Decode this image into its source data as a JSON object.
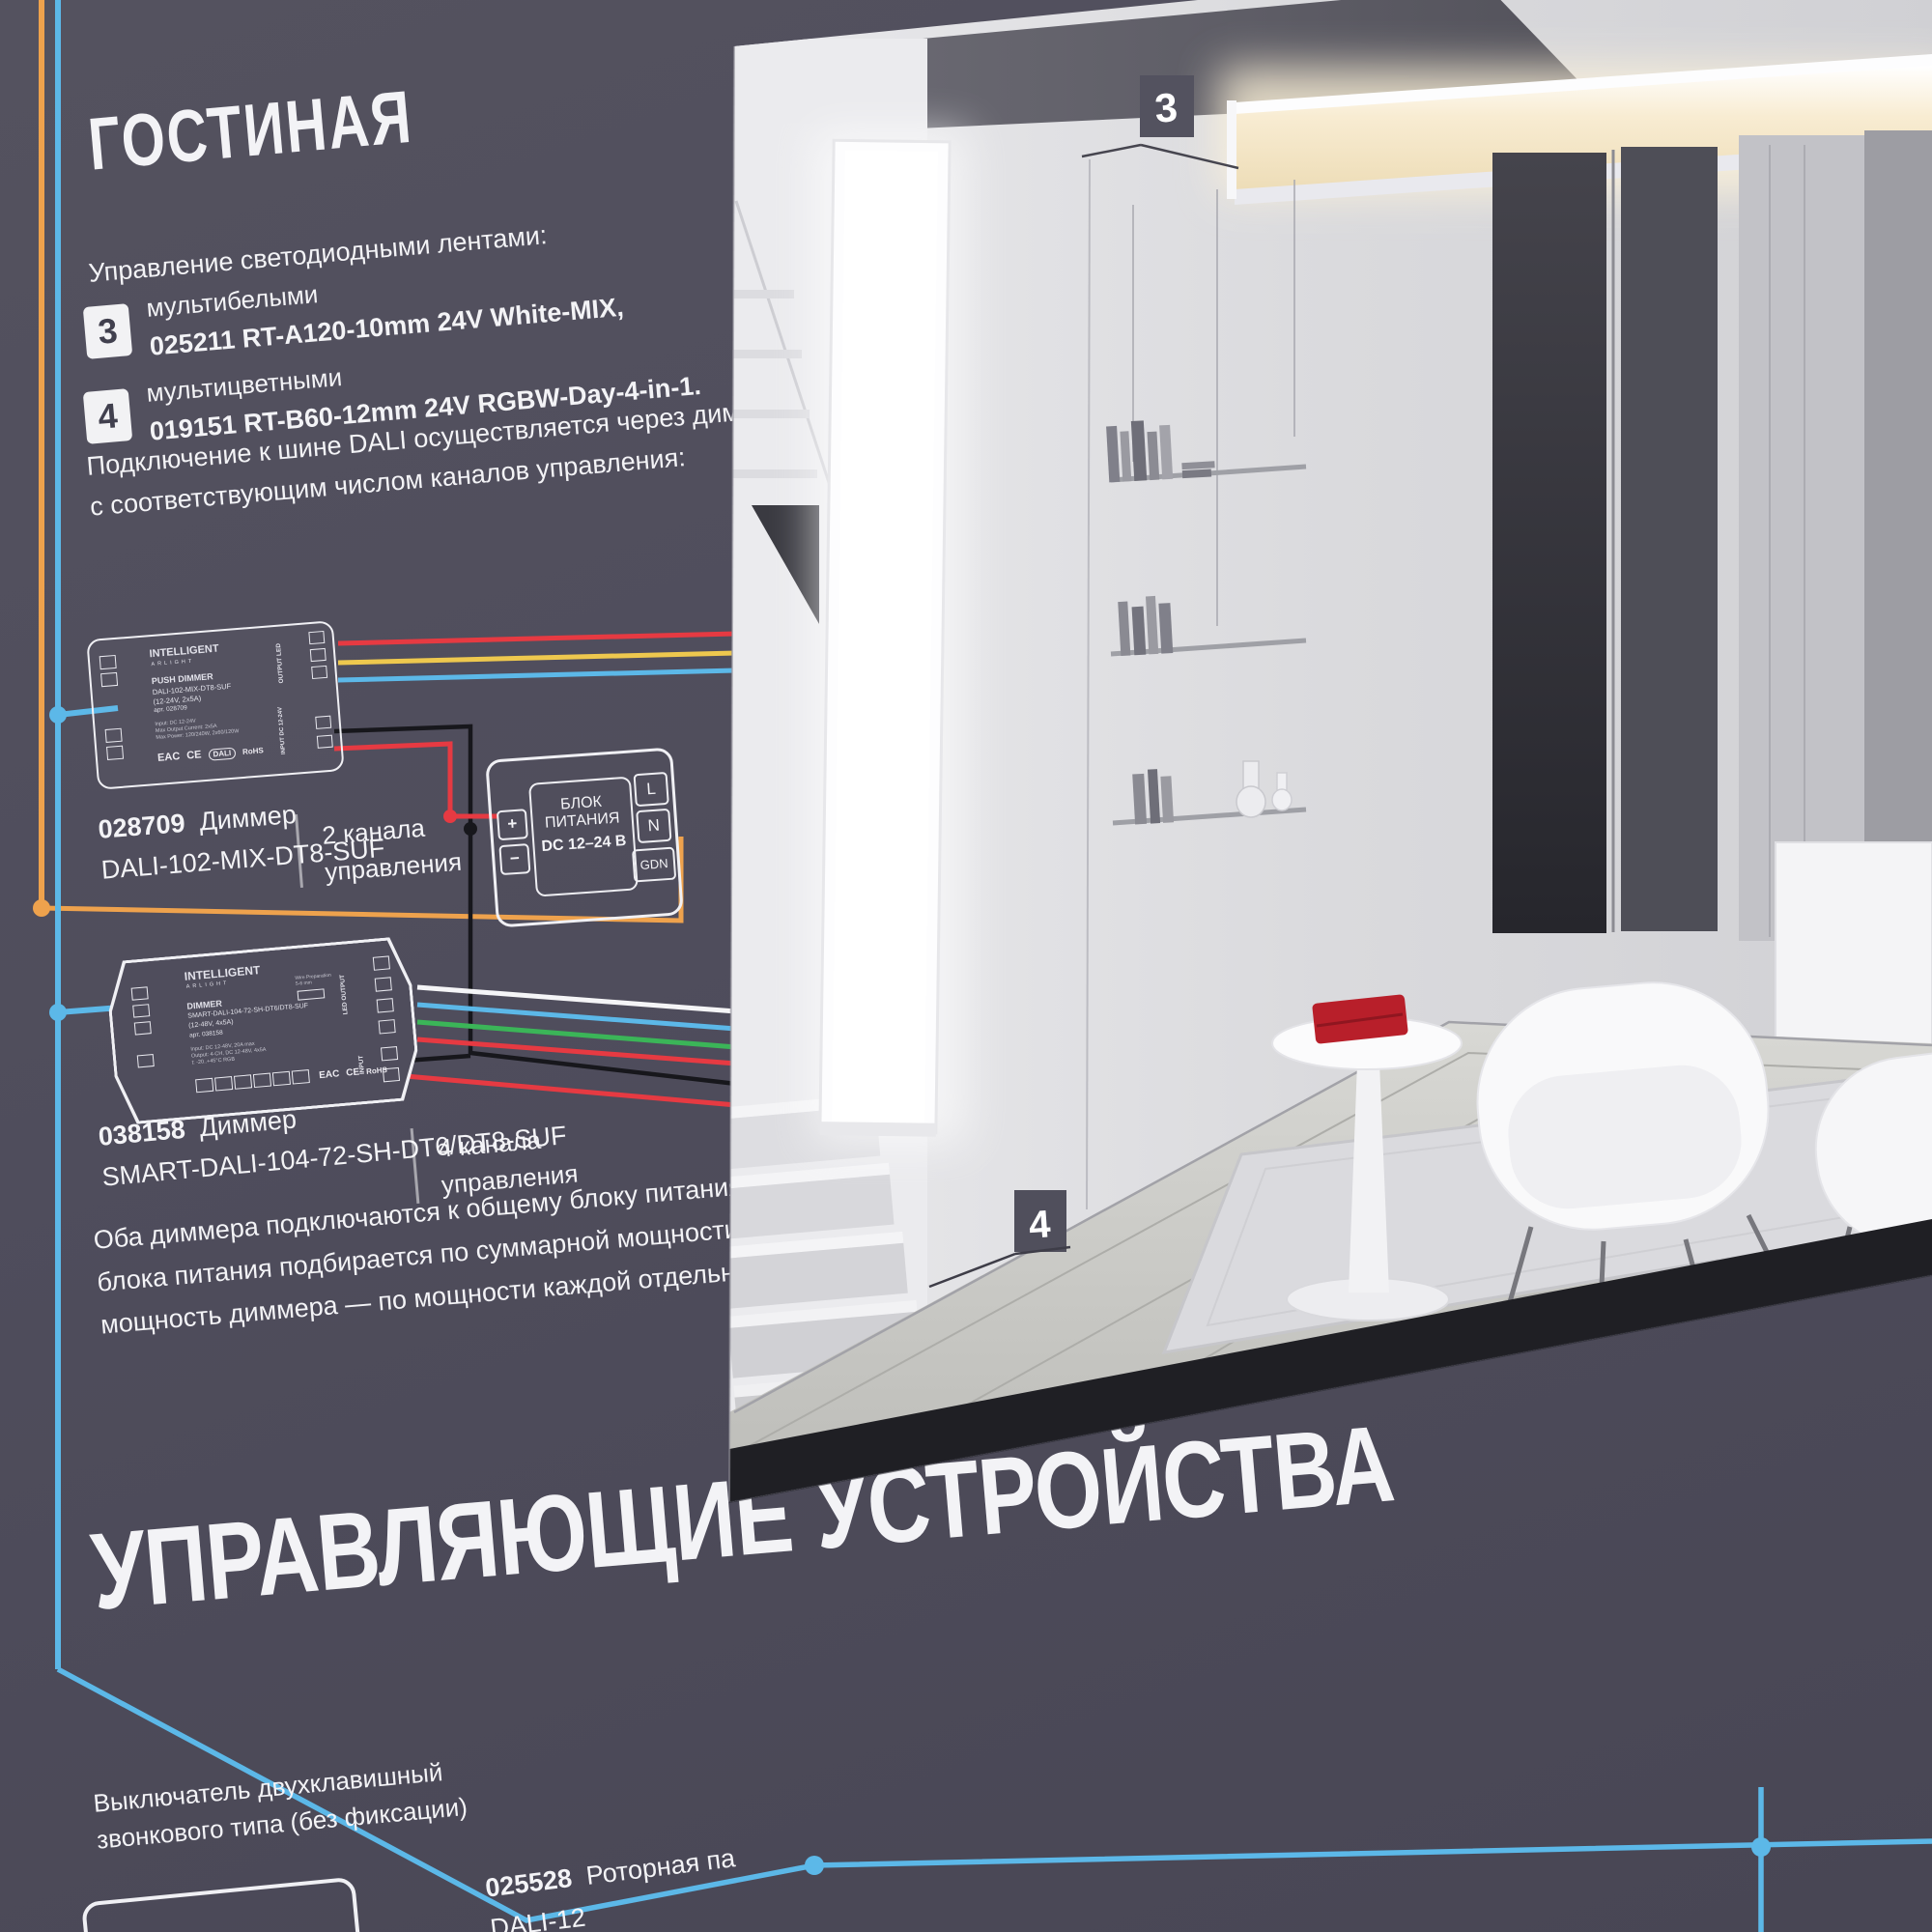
{
  "colors": {
    "board_bg": "#4f4d5c",
    "wire_orange": "#eea24d",
    "wire_cyan": "#5cb8e8",
    "wire_red": "#e63a42",
    "wire_yellow": "#eec84e",
    "wire_green": "#3bb558",
    "wire_white": "#f5f5f7",
    "wire_black": "#17171c",
    "accent_red_object": "#b81f2a",
    "led_warm": "#f3e3c3"
  },
  "header": {
    "title": "ГОСТИНАЯ"
  },
  "intro": "Управление светодиодными лентами:",
  "strips": [
    {
      "badge": "3",
      "kind": "мультибелыми",
      "model": "025211 RT-A120-10mm 24V White-MIX,"
    },
    {
      "badge": "4",
      "kind": "мультицветными",
      "model": "019151 RT-B60-12mm 24V RGBW-Day-4-in-1."
    }
  ],
  "dali_note": [
    "Подключение к шине DALI осуществляется через диммеры DALI",
    "с соответствующим числом каналов управления:"
  ],
  "dimmer1": {
    "art": "028709",
    "name": "Диммер",
    "model": "DALI-102-MIX-DT8-SUF",
    "channels_1": "2 канала",
    "channels_2": "управления",
    "device": {
      "brand": "INTELLIGENT",
      "brand_sub": "ARLIGHT",
      "title": "PUSH DIMMER",
      "model": "DALI-102-MIX-DT8-SUF",
      "rating": "(12-24V, 2x5A)",
      "art": "арт. 028709",
      "specs": [
        "Input: DC 12-24V",
        "Max Output Current: 2x5A",
        "Max Power: 120/240W, 2x60/120W"
      ],
      "out_label": "OUTPUT LED",
      "in_label": "INPUT DC 12-24V",
      "marks": [
        "EAC",
        "CE",
        "DALI",
        "RoHS"
      ]
    }
  },
  "psu": {
    "l1": "БЛОК",
    "l2": "ПИТАНИЯ",
    "l3": "DC 12–24 В",
    "plus": "+",
    "minus": "−",
    "t1": "L",
    "t2": "N",
    "t3": "GDN"
  },
  "dimmer2": {
    "art": "038158",
    "name": "Диммер",
    "model": "SMART-DALI-104-72-SH-DT6/DT8-SUF",
    "channels_1": "4 канала",
    "channels_2": "управления",
    "device": {
      "brand": "INTELLIGENT",
      "brand_sub": "ARLIGHT",
      "title": "DIMMER",
      "model": "SMART-DALI-104-72-SH-DT6/DT8-SUF",
      "rating": "(12-48V, 4x5A)",
      "art": "арт. 038158",
      "specs": [
        "Input: DC 12-48V, 20A max",
        "Output: 4-CH, DC 12-48V, 4x5A",
        "t: -20..+45°C   RGB"
      ],
      "out_label": "LED OUTPUT",
      "in_label": "INPUT",
      "marks": [
        "EAC",
        "CE",
        "RoHS"
      ]
    }
  },
  "note2": [
    "Оба диммера подключаются к общему блоку питания. Мощность",
    "блока питания подбирается по суммарной мощности обеих лент,",
    "мощность диммера — по мощности каждой отдельной ленты."
  ],
  "heading2": "УПРАВЛЯЮЩИЕ УСТРОЙСТВА",
  "footer": {
    "left1": "Выключатель двухклавишный",
    "left2": "звонкового типа (без фиксации)",
    "right_art": "025528",
    "right_name": "Роторная па",
    "right_model": "DALI-12"
  },
  "scene": {
    "badge3": "3",
    "badge4": "4"
  }
}
